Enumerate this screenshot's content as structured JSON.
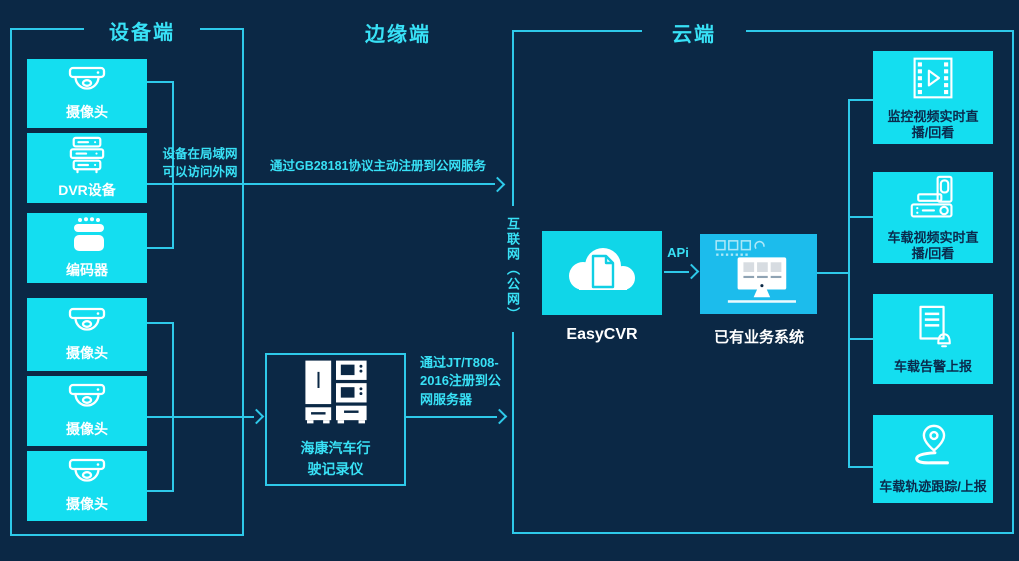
{
  "titles": {
    "device": "设备端",
    "edge": "边缘端",
    "cloud": "云端"
  },
  "device_boxes": [
    {
      "label": "摄像头",
      "icon": "dome-camera-icon"
    },
    {
      "label": "DVR设备",
      "icon": "dvr-icon"
    },
    {
      "label": "编码器",
      "icon": "encoder-icon"
    },
    {
      "label": "摄像头",
      "icon": "dome-camera-icon"
    },
    {
      "label": "摄像头",
      "icon": "dome-camera-icon"
    },
    {
      "label": "摄像头",
      "icon": "dome-camera-icon"
    }
  ],
  "notes": {
    "lan": "设备在局域网\n可以访问外网",
    "gb28181": "通过GB28181协议主动注册到公网服务",
    "jt808": "通过JT/T808-\n2016注册到公\n网服务器",
    "internet": "互联网（公网）",
    "api": "APi"
  },
  "edge_device": {
    "label": "海康汽车行\n驶记录仪",
    "icon": "dashcam-recorder-icon"
  },
  "cloud": {
    "easycvr": {
      "label": "EasyCVR",
      "icon": "cloud-document-icon"
    },
    "business": {
      "label": "已有业务系统",
      "icon": "desktop-monitor-icon"
    },
    "outputs": [
      {
        "label": "监控视频实时直\n播/回看",
        "icon": "film-play-icon"
      },
      {
        "label": "车载视频实时直\n播/回看",
        "icon": "vehicle-dvr-icon"
      },
      {
        "label": "车载告警上报",
        "icon": "alert-report-icon"
      },
      {
        "label": "车载轨迹跟踪/上报",
        "icon": "location-track-icon"
      }
    ]
  },
  "colors": {
    "background": "#0B2845",
    "cyan_fill": "#14DEF0",
    "easycvr_fill": "#10D6E8",
    "business_fill": "#1CBCEC",
    "line": "#2EC9E9",
    "accent_text": "#38E1F6",
    "dark_text": "#0A2A4C",
    "icon_white": "#FFFFFF"
  }
}
